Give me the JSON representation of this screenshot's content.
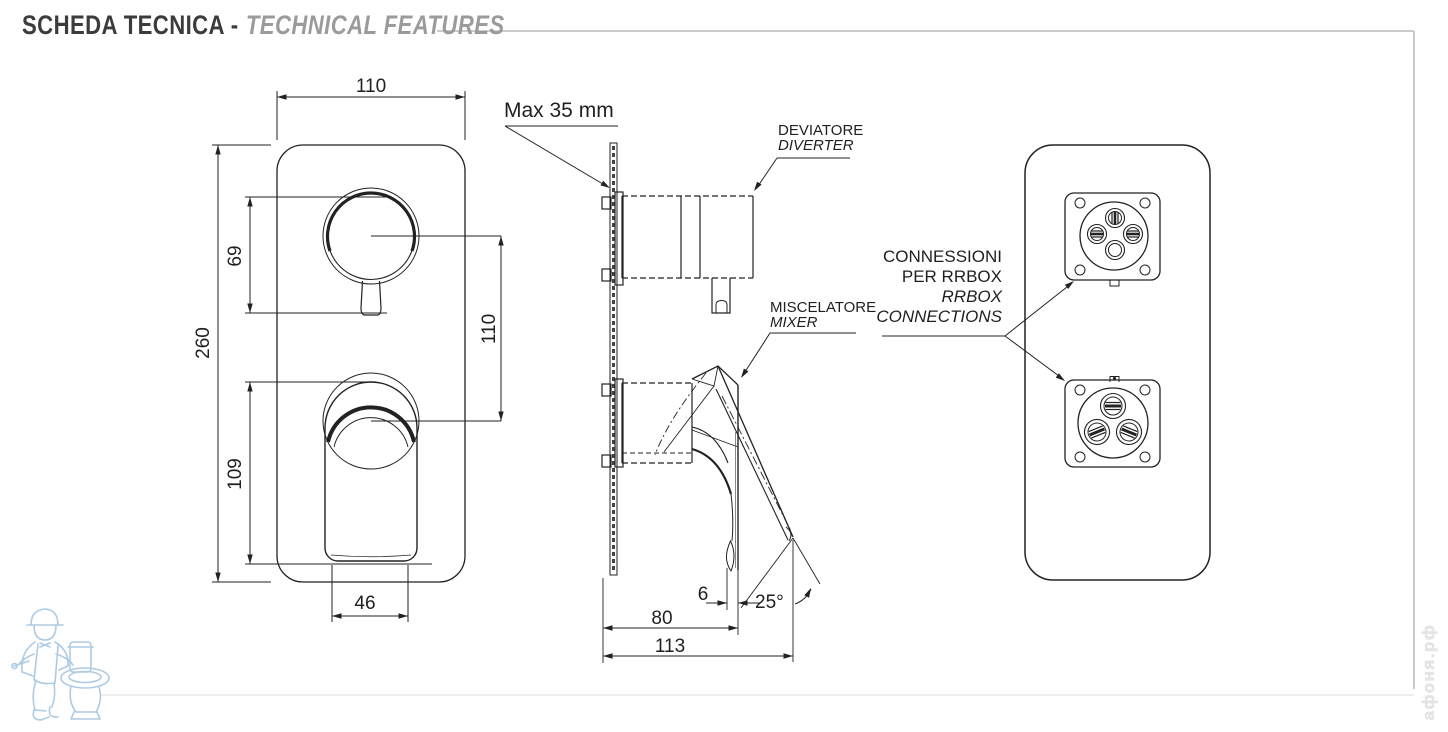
{
  "title": {
    "italian": "SCHEDA TECNICA -",
    "english": "TECHNICAL FEATURES"
  },
  "front_view": {
    "dim_plate_width": "110",
    "dim_plate_height": "260",
    "dim_diverter_span": "69",
    "dim_handle_span": "109",
    "dim_centers_distance": "110",
    "dim_handle_width": "46"
  },
  "side_view": {
    "wall_thickness_note": "Max 35 mm",
    "diverter_label_it": "DEVIATORE",
    "diverter_label_en": "DIVERTER",
    "mixer_label_it": "MISCELATORE",
    "mixer_label_en": "MIXER",
    "dim_handle_offset": "6",
    "dim_handle_angle": "25°",
    "dim_depth_to_handle": "80",
    "dim_depth_total": "113"
  },
  "back_view": {
    "connections_label_line1": "CONNESSIONI",
    "connections_label_line2": "PER RRBOX",
    "connections_label_line3": "RRBOX",
    "connections_label_line4": "CONNECTIONS"
  },
  "watermark": {
    "site_name": "афоня.рф"
  },
  "colors": {
    "line": "#1f1f1f",
    "title_primary": "#3c3c3c",
    "title_secondary": "#9b9b9b",
    "rule": "#cbcbcb",
    "watermark_blue": "#aecbe4",
    "watermark_gray": "#e4e4e4"
  }
}
